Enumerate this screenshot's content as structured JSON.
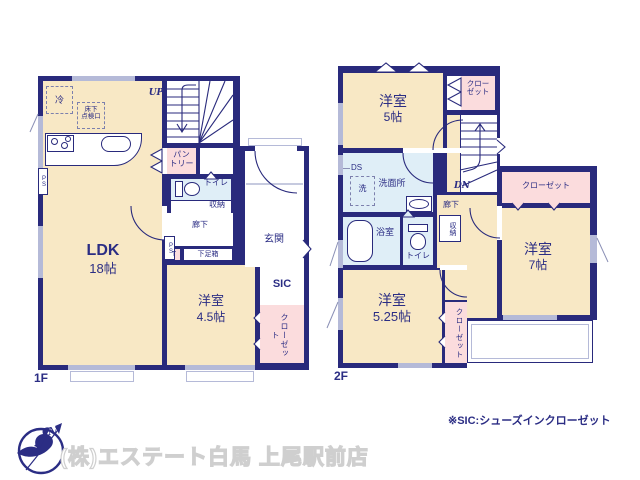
{
  "plan": {
    "f1": {
      "floor_label": "1F",
      "ldk_name": "LDK",
      "ldk_size": "18帖",
      "room45_name": "洋室",
      "room45_size": "4.5帖",
      "genkan": "玄関",
      "rouka": "廊下",
      "toilet": "トイレ",
      "shuno": "収納",
      "pantry": "パン\nトリー",
      "sic": "SIC",
      "closet": "クローゼット",
      "getabako": "下足箱",
      "t_box": "T",
      "up": "UP",
      "fridge": "冷",
      "hatch": "床下\n点検口",
      "ps": "PS"
    },
    "f2": {
      "floor_label": "2F",
      "room5_name": "洋室",
      "room5_size": "5帖",
      "room7_name": "洋室",
      "room7_size": "7帖",
      "room525_name": "洋室",
      "room525_size": "5.25帖",
      "senmenjo": "洗面所",
      "bath": "浴室",
      "toilet": "トイレ",
      "shuno": "収納",
      "rouka": "廊下",
      "closet": "クローゼット",
      "closet_wrap": "クロー\nゼット",
      "ds": "DS",
      "washer": "洗",
      "dn": "DN"
    },
    "footnote": "※SIC:シューズインクローゼット"
  },
  "branding": {
    "company": "(株)エステート白馬 上尾駅前店",
    "compass_n": "N"
  },
  "colors": {
    "wall": "#292a7c",
    "text": "#2b2d84",
    "room_cream": "#f8e8c5",
    "closet_pink": "#fbdcdd",
    "wet_blue": "#dfeef7",
    "window_gray": "#b5bad8"
  }
}
